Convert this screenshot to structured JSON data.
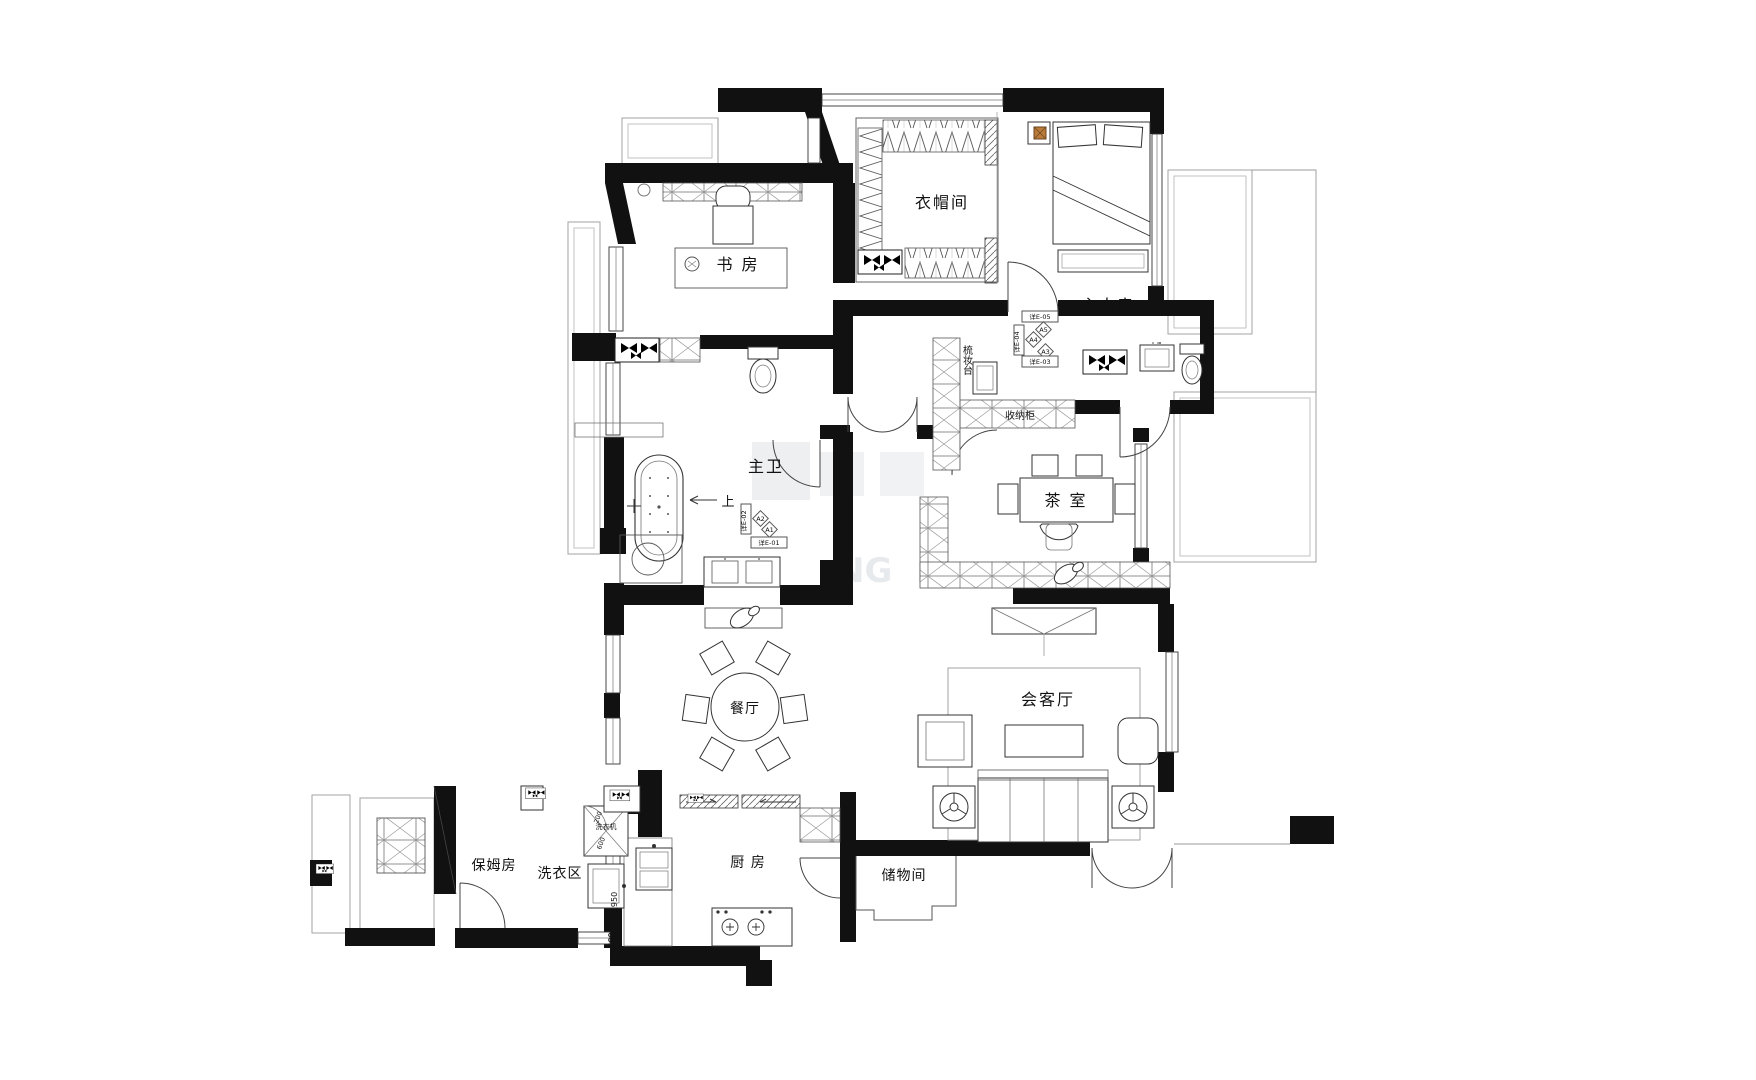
{
  "rooms": {
    "cloakroom": "衣帽间",
    "master": "主人房",
    "study": "书 房",
    "master_bath": "主卫",
    "tea": "茶 室",
    "dining": "餐厅",
    "living": "会客厅",
    "nanny": "保姆房",
    "laundry": "洗衣区",
    "kitchen": "厨 房",
    "storage": "储物间"
  },
  "annotations": {
    "dressing_table": "梳妆台",
    "storage_cabinet": "收纳柜",
    "washing_machine": "洗衣机",
    "up": "上"
  },
  "markers": {
    "e05": "详E-05",
    "e04": "详E-04",
    "e03": "详E-03",
    "e02": "详E-02",
    "e01": "详E-01",
    "a5": "A5",
    "a4": "A4",
    "a3": "A3",
    "a2": "A2",
    "a1": "A1"
  },
  "dimensions": {
    "d1950": "1950",
    "d500": "500",
    "d200": "200",
    "d600": "600"
  },
  "watermark": "NG",
  "colors": {
    "wall": "#111111",
    "line": "#333333",
    "thin": "#888888",
    "lamp_accent": "#b97a3a",
    "watermark": "#ccd2d8"
  }
}
